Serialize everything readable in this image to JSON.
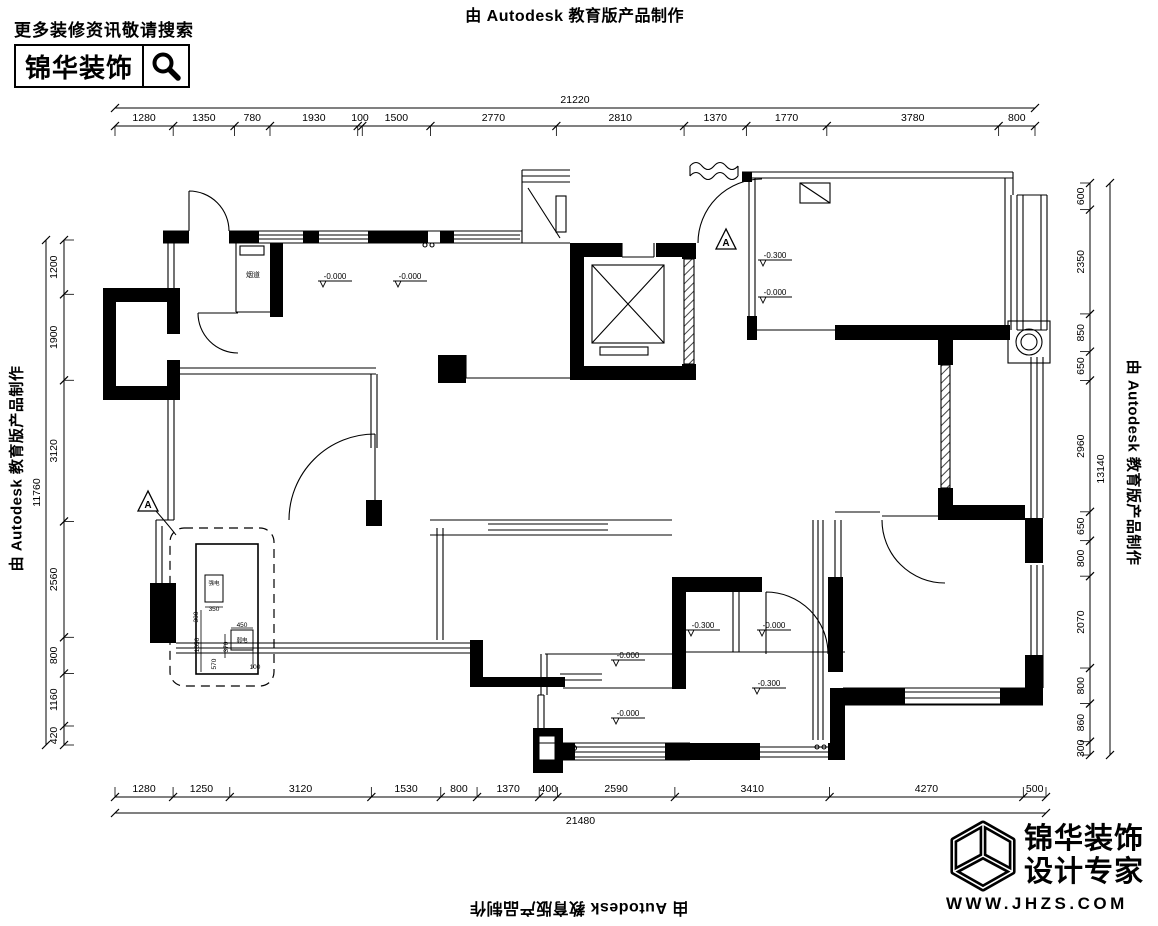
{
  "stamps": {
    "top": "由 Autodesk 教育版产品制作",
    "left": "由 Autodesk 教育版产品制作",
    "right": "由 Autodesk 教育版产品制作",
    "bottom": "由 Autodesk 教育版产品制作"
  },
  "header_logo": {
    "tagline": "更多装修资讯敬请搜索",
    "brand": "锦华装饰"
  },
  "footer_logo": {
    "brand": "锦华装饰",
    "subtitle": "设计专家",
    "website": "WWW.JHZS.COM"
  },
  "dimensions": {
    "top": {
      "total": 21220,
      "segments": [
        1280,
        1350,
        780,
        1930,
        100,
        1500,
        2770,
        2810,
        1370,
        1770,
        3780,
        800
      ]
    },
    "bottom": {
      "total": 21480,
      "segments": [
        1280,
        1250,
        3120,
        1530,
        800,
        1370,
        400,
        2590,
        3410,
        4270,
        500
      ]
    },
    "left": {
      "total": 11760,
      "segments": [
        1200,
        1900,
        3120,
        2560,
        800,
        1160,
        420
      ]
    },
    "right": {
      "total": 13140,
      "segments": [
        600,
        2350,
        850,
        650,
        2960,
        650,
        800,
        2070,
        800,
        860,
        300
      ]
    }
  },
  "plan": {
    "detail_marker": "A",
    "flue_label": "烟道",
    "elevation_markers": [
      "-0.000",
      "-0.000",
      "-0.300",
      "-0.000",
      "-0.300",
      "-0.000",
      "-0.000",
      "-0.300",
      "-0.000"
    ],
    "detail": {
      "dims": [
        "350",
        "300",
        "1650",
        "570",
        "370",
        "450",
        "100"
      ],
      "box_labels": [
        "强电",
        "弱电"
      ]
    }
  },
  "colors": {
    "ink": "#000000",
    "paper": "#ffffff"
  }
}
